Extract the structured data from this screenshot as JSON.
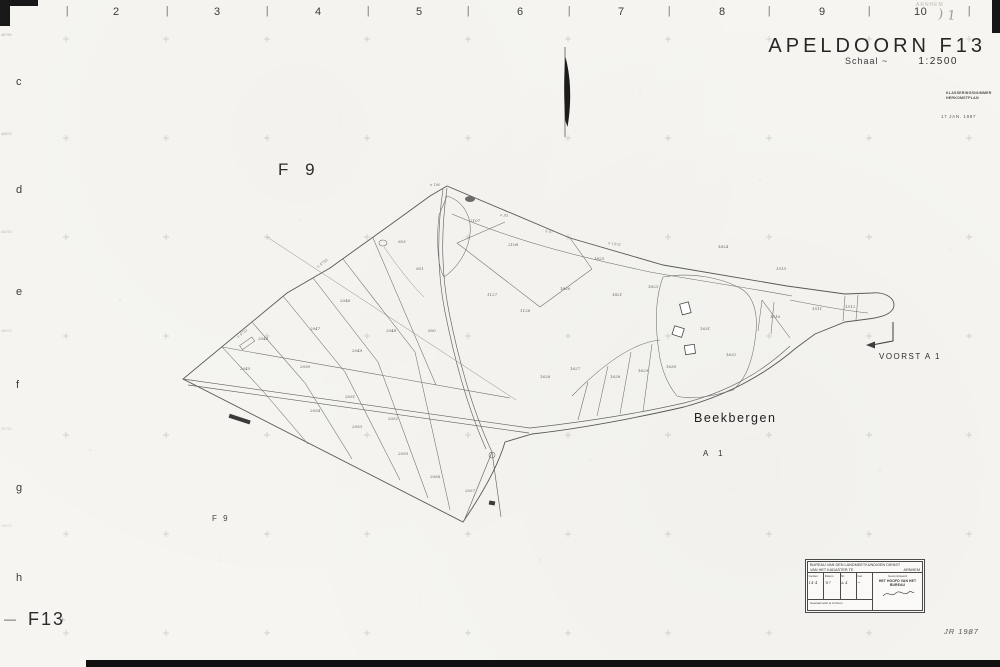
{
  "sheet": {
    "title": "APELDOORN F13",
    "scale_label": "Schaal ~",
    "scale_value": "1:2500",
    "corner_code": "F13",
    "corner_code_dash": "—",
    "corner_code_plus": "+",
    "year_note": "JR 1987",
    "pencil_note": ") 1",
    "pencil_note_small": "ARNHEM",
    "classification_line1": "KLASSERINGSNUMMER",
    "classification_line2": "HERKOMSTPLAN",
    "date_stamp": "17 JAN. 1987"
  },
  "grid": {
    "top_numbers": [
      "2",
      "3",
      "4",
      "5",
      "6",
      "7",
      "8",
      "9",
      "10"
    ],
    "tick_glyph": "|",
    "left_letters": [
      "c",
      "d",
      "e",
      "f",
      "g",
      "h"
    ],
    "edge_coords": [
      "46750",
      "46500",
      "46250",
      "46000",
      "45750",
      "45500"
    ]
  },
  "map": {
    "sheet_label_big": "F 9",
    "sheet_label_small": "F 9",
    "place_label": "Beekbergen",
    "road_label": "A 1",
    "neighbour_label": "VOORST  A 1",
    "parcel_numbers": [
      {
        "x": 398,
        "y": 243,
        "t": "953"
      },
      {
        "x": 416,
        "y": 270,
        "t": "951"
      },
      {
        "x": 428,
        "y": 332,
        "t": "950"
      },
      {
        "x": 487,
        "y": 296,
        "t": "1127"
      },
      {
        "x": 520,
        "y": 312,
        "t": "1126"
      },
      {
        "x": 560,
        "y": 290,
        "t": "1820"
      },
      {
        "x": 612,
        "y": 296,
        "t": "1821"
      },
      {
        "x": 648,
        "y": 288,
        "t": "1823"
      },
      {
        "x": 594,
        "y": 260,
        "t": "1825"
      },
      {
        "x": 470,
        "y": 222,
        "t": "2107"
      },
      {
        "x": 508,
        "y": 246,
        "t": "2108"
      },
      {
        "x": 310,
        "y": 330,
        "t": "2047"
      },
      {
        "x": 352,
        "y": 352,
        "t": "2049"
      },
      {
        "x": 386,
        "y": 332,
        "t": "2048"
      },
      {
        "x": 340,
        "y": 302,
        "t": "2046"
      },
      {
        "x": 258,
        "y": 340,
        "t": "2044"
      },
      {
        "x": 240,
        "y": 370,
        "t": "2045"
      },
      {
        "x": 300,
        "y": 368,
        "t": "2050"
      },
      {
        "x": 345,
        "y": 398,
        "t": "2051"
      },
      {
        "x": 388,
        "y": 420,
        "t": "2052"
      },
      {
        "x": 352,
        "y": 428,
        "t": "2053"
      },
      {
        "x": 310,
        "y": 412,
        "t": "2054"
      },
      {
        "x": 398,
        "y": 455,
        "t": "2055"
      },
      {
        "x": 430,
        "y": 478,
        "t": "2056"
      },
      {
        "x": 465,
        "y": 492,
        "t": "2057"
      },
      {
        "x": 540,
        "y": 378,
        "t": "1626"
      },
      {
        "x": 570,
        "y": 370,
        "t": "1627"
      },
      {
        "x": 610,
        "y": 378,
        "t": "1628"
      },
      {
        "x": 638,
        "y": 372,
        "t": "1629"
      },
      {
        "x": 666,
        "y": 368,
        "t": "1630"
      },
      {
        "x": 700,
        "y": 330,
        "t": "1631"
      },
      {
        "x": 726,
        "y": 356,
        "t": "1632"
      },
      {
        "x": 770,
        "y": 318,
        "t": "1510"
      },
      {
        "x": 812,
        "y": 310,
        "t": "1511"
      },
      {
        "x": 845,
        "y": 308,
        "t": "1512"
      },
      {
        "x": 718,
        "y": 248,
        "t": "1824"
      },
      {
        "x": 776,
        "y": 270,
        "t": "1515"
      }
    ],
    "road_numbers": [
      {
        "x": 608,
        "y": 244,
        "t": "n 1473",
        "r": 10
      },
      {
        "x": 500,
        "y": 216,
        "t": "n 93",
        "r": 8
      },
      {
        "x": 318,
        "y": 268,
        "t": "n 4730",
        "r": -37
      },
      {
        "x": 238,
        "y": 338,
        "t": "n 4731",
        "r": -37
      },
      {
        "x": 430,
        "y": 186,
        "t": "n 180",
        "r": 0
      },
      {
        "x": 545,
        "y": 232,
        "t": "5 47",
        "r": 10
      }
    ]
  },
  "stamp": {
    "line1": "BUREAU VAN DEN LANDMEETKUNDIGEN DIENST",
    "line2": "VAN HET KADASTER TE",
    "line2_right": "ARNHEM",
    "columns": [
      "Gezien",
      "Datum",
      "Nr.",
      "Get."
    ],
    "hand_values": [
      "14-4",
      "'87",
      "A 4",
      "~"
    ],
    "right_header": "Gecontroleerd",
    "right_title": "HET HOOFD VAN HET BUREAU",
    "bottom_note": "Gewaarmerkt te Arnhem"
  }
}
